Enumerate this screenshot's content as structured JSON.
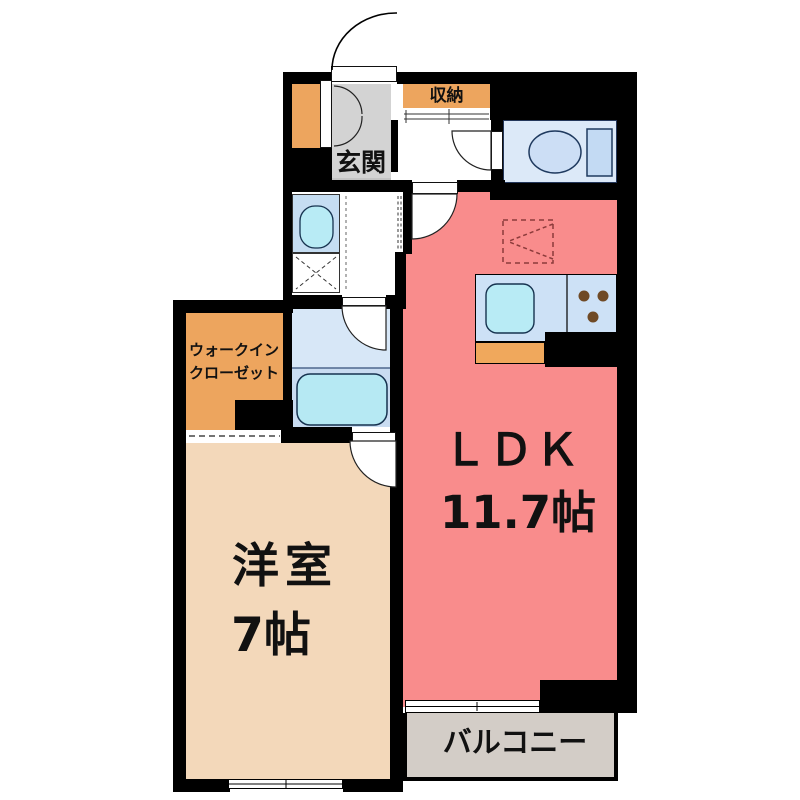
{
  "labels": {
    "entrance": "玄関",
    "storage": "収納",
    "walkin_line1": "ウォークイン",
    "walkin_line2": "クローゼット",
    "bedroom_name": "洋室",
    "bedroom_size": "7帖",
    "ldk_name": "ＬＤＫ",
    "ldk_size": "11.7帖",
    "balcony": "バルコニー"
  },
  "colors": {
    "wall": "#000000",
    "ldk": "#f98c8c",
    "bedroom": "#f3d8ba",
    "closet": "#eda55e",
    "entrance": "#d3d3d3",
    "balcony": "#d3cdc7",
    "toilet_room": "#dce9f8",
    "sink_unit": "#c5ddf2",
    "bath_upper": "#d7e7f7",
    "bath_lower": "#c9dcf1",
    "counter": "#cde1f6",
    "fixture": "#b8ebf5",
    "tub": "#b6e9f3",
    "counter_orange": "#f0a85c",
    "stove_dot": "#6f4a26",
    "fridge_dash": "#8c3b3b"
  }
}
